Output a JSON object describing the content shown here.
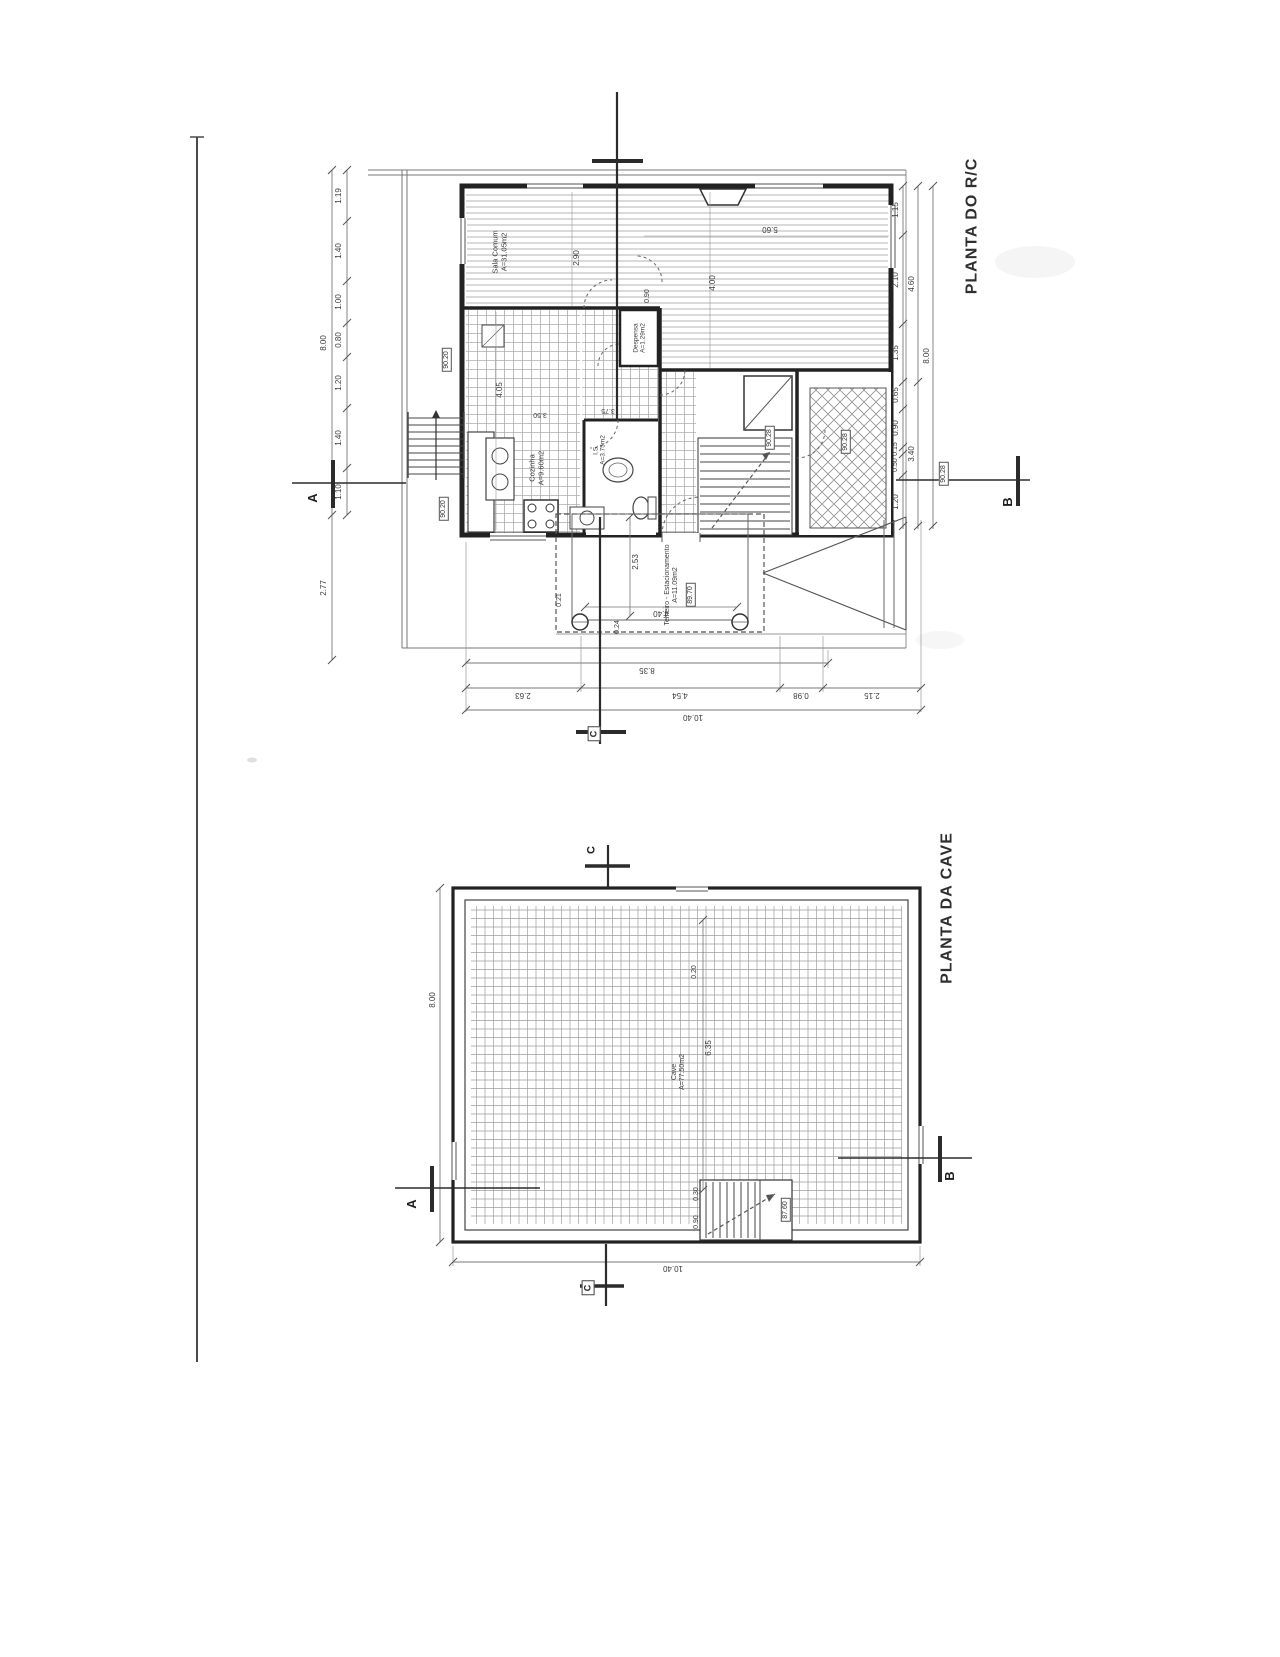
{
  "sheet": {
    "title_rc": "PLANTA DO R/C",
    "title_cave": "PLANTA DA CAVE"
  },
  "markers": {
    "a": "A",
    "b": "B",
    "c": "C"
  },
  "rc": {
    "dims": {
      "left": [
        "1.19",
        "1.40",
        "1.00",
        "0.80",
        "1.20",
        "1.40",
        "1.10"
      ],
      "left_total": "8.00",
      "left_below": "2.77",
      "right": [
        "1.15",
        "2.10",
        "1.35",
        "0.65",
        "0.90",
        "0.15",
        "0.50",
        "1.20"
      ],
      "right_subtotals": [
        "4.60",
        "3.40"
      ],
      "right_total": "8.00",
      "bottom_upper": "8.35",
      "bottom": [
        "2.63",
        "4.54",
        "0.98",
        "2.15"
      ],
      "bottom_total": "10.40",
      "sala_depth": "2.90",
      "sala_height": "4.00",
      "sala_width": "5.60",
      "door": "0.90",
      "kitchen_depth": "4.05",
      "hall_a": "3.50",
      "hall_b": "3.75",
      "car_depth": "2.53",
      "car_width": "4.40",
      "car_off_a": "0.21",
      "car_off_b": "0.24"
    },
    "levels": {
      "walk_a": "90.20",
      "walk_b": "90.20",
      "hall": "90.28",
      "patio": "90.28",
      "entry": "90.28",
      "car": "89.70"
    },
    "rooms": {
      "sala": {
        "name": "Sala Comum",
        "area": "A=31.05m2"
      },
      "cozinha": {
        "name": "Cozinha",
        "area": "A=9.60m2"
      },
      "despensa": {
        "name": "Despensa",
        "area": "A=1.29m2"
      },
      "is": {
        "name": "I.S.",
        "area": "A=3.75m2"
      },
      "telheiro": {
        "name": "Telheiro - Estacionamento",
        "area": "A=11.09m2"
      }
    }
  },
  "cave": {
    "dims": {
      "left_total": "8.00",
      "bottom_total": "10.40",
      "inner": "6.35",
      "wall": "0.20",
      "stair_a": "0.30",
      "stair_b": "0.90"
    },
    "level": "87.60",
    "room": {
      "name": "Cave",
      "area": "A=77.50m2"
    }
  }
}
